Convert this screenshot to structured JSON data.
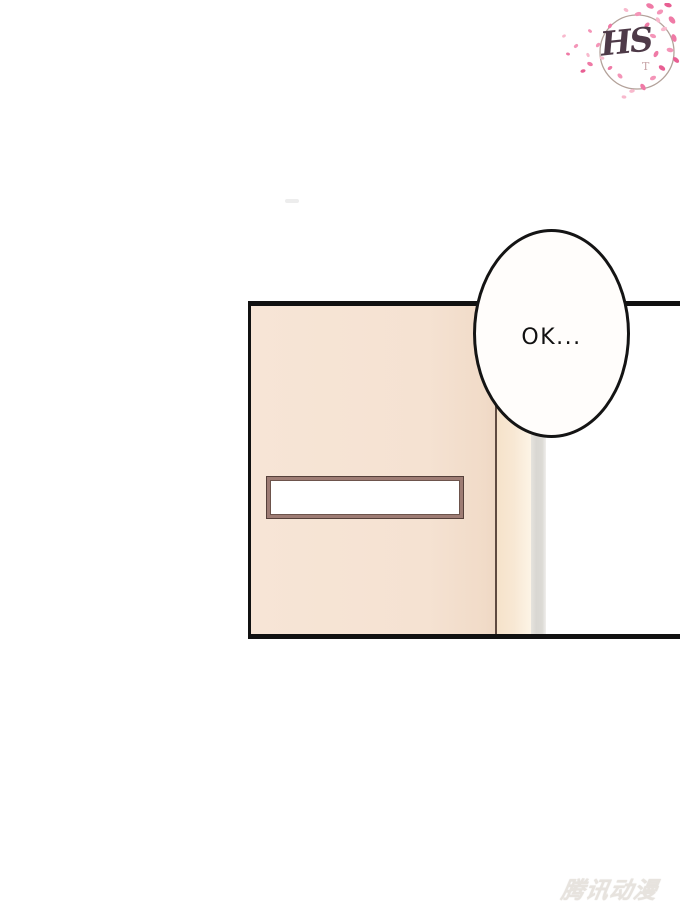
{
  "page": {
    "background": "#ffffff"
  },
  "logo": {
    "monogram": "HS",
    "subscript": "T",
    "monogram_color": "#4e3a48",
    "subscript_color": "#c7a3a6",
    "circle_color": "#b3a29a",
    "petal_colors": [
      "#e85f93",
      "#ef7aa6",
      "#f495b8",
      "#f8b9cd"
    ]
  },
  "panel": {
    "border_color": "#111111",
    "door_color": "#f5e2d2",
    "door_edge_line_color": "#5f4a40",
    "door_edge_strip_color": "#f8e8d4",
    "wall_strip_color": "#dcdad5",
    "name_plate": {
      "frame_color": "#9e7c74",
      "frame_outline_color": "#55403a",
      "fill_color": "#ffffff"
    }
  },
  "speech_bubble": {
    "text": "OK...",
    "fill": "#fffdfb",
    "stroke": "#141414"
  },
  "watermark": {
    "text": "腾讯动漫",
    "color": "#e7e3de"
  }
}
